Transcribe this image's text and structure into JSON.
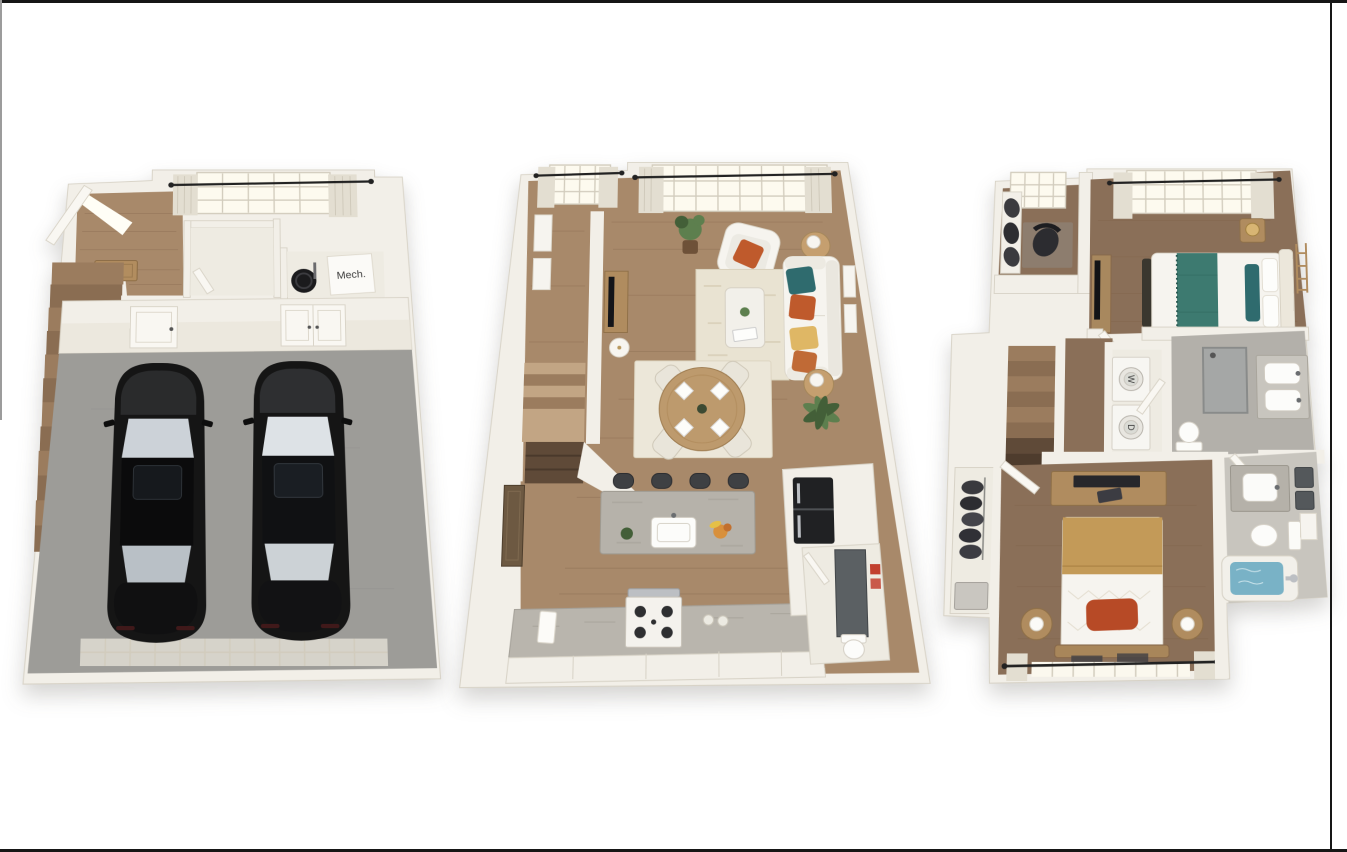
{
  "canvas": {
    "width": 1347,
    "height": 852,
    "background": "#ffffff"
  },
  "labels": {
    "mechanical_room": "Mech.",
    "washer": "W",
    "dryer": "D"
  },
  "floors": [
    {
      "id": "garage-level",
      "items": [
        "open-front-door",
        "doormat",
        "staircase",
        "closet",
        "mechanical-room",
        "water-heater",
        "mech-label-box",
        "window-with-curtains",
        "garage-door-to-house",
        "garage-double-door",
        "garage",
        "car-left",
        "car-right",
        "garage-door-strip"
      ]
    },
    {
      "id": "main-level",
      "items": [
        "staircase",
        "wall-art",
        "window-small",
        "window-large",
        "potted-plant",
        "armchair",
        "side-table-lamp-top",
        "sofa",
        "throw-pillows",
        "area-rug",
        "coffee-table",
        "tv-console",
        "floor-lamp",
        "side-table-lamp-bottom",
        "dining-rug",
        "round-dining-table",
        "dining-chairs",
        "place-settings",
        "kitchen-island",
        "island-sink",
        "bar-stools",
        "fruit-bowl",
        "kitchen-counter",
        "gas-range",
        "towel",
        "refrigerator",
        "pantry-cabinets",
        "palm-plant",
        "powder-room",
        "powder-mirror",
        "red-towels",
        "toilet",
        "dark-side-panel"
      ]
    },
    {
      "id": "bedroom-level",
      "items": [
        "den-nook",
        "den-window",
        "den-chair",
        "den-cushions",
        "staircase",
        "hallway",
        "stacked-washer-dryer",
        "bathroom-1",
        "shower",
        "double-vanity",
        "toilet-1",
        "bedroom-1",
        "bed-1-teal-accents",
        "nightstand-gold-lamp",
        "tv-console",
        "ladder-decor",
        "closet-with-clothes",
        "bedroom-2",
        "dresser-with-laptop",
        "bed-2-camel-blanket",
        "rust-pillow",
        "round-nightstands",
        "window-with-rod",
        "bathroom-2",
        "vanity-2",
        "mirrors",
        "toilet-2",
        "bathtub-blue-water",
        "faucet"
      ]
    }
  ],
  "colors": {
    "pageBg": "#ffffff",
    "frameLine": "#161616",
    "sideLine": "#9c9c9c",
    "wall": "#f2efe8",
    "wallEdge": "#d8d3c7",
    "wallFace": "#e7e2d5",
    "floorCream": "#eeebe2",
    "wood": "#a8896a",
    "woodDark": "#8a6f58",
    "woodLight": "#c2a584",
    "plank": "#7d6046",
    "stair": "#9b7c5e",
    "stairAlt": "#8a6d52",
    "stairDark": "#5f4a38",
    "garage": "#9d9c98",
    "garageDoor": "#d6d3ca",
    "carBody": "#151515",
    "carTrim": "#3f4144",
    "carGlass": "#ccd2d8",
    "carGlassLight": "#dde2e6",
    "rug": "#e9e3d2",
    "rugPale": "#ece7d9",
    "white": "#f6f4ef",
    "cream": "#e3ded1",
    "teal": "#2f6b6e",
    "tealDark": "#3d7a70",
    "orange": "#bf5a2c",
    "rust": "#b74a26",
    "yellow": "#dfb765",
    "camel": "#c39a58",
    "gold": "#d8b573",
    "island": "#b6b2aa",
    "counter": "#b9b5ad",
    "appliance": "#202123",
    "steel": "#bcbfc3",
    "tile": "#b3b0aa",
    "tileLight": "#c8c5be",
    "tubBlue": "#79b2c6",
    "green": "#5d7f4e",
    "greenDark": "#435f38",
    "pot": "#6e5138",
    "mat": "#b28d5f",
    "textDark": "#3a3a3a",
    "red": "#c2402f"
  }
}
